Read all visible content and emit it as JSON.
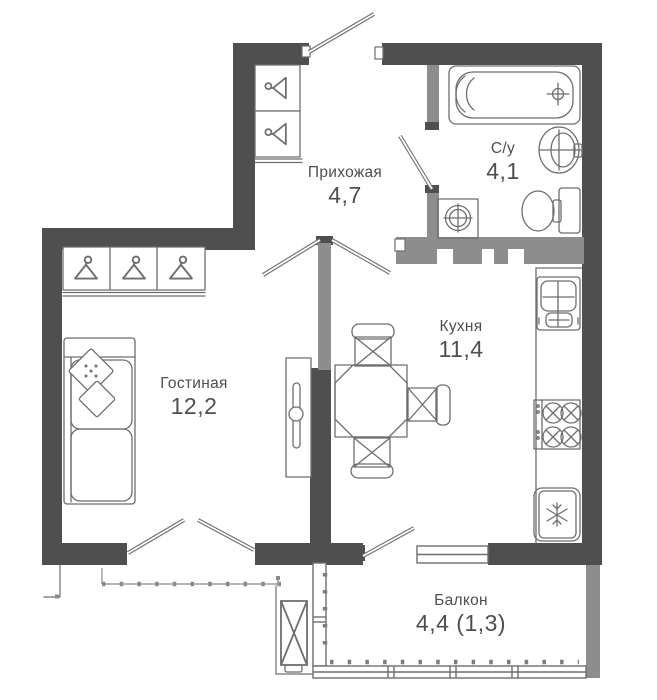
{
  "plan": {
    "type": "apartment-floor-plan",
    "rooms": [
      {
        "id": "hallway",
        "name": "Прихожая",
        "area": "4,7"
      },
      {
        "id": "bathroom",
        "name": "С/у",
        "area": "4,1"
      },
      {
        "id": "kitchen",
        "name": "Кухня",
        "area": "11,4"
      },
      {
        "id": "living",
        "name": "Гостиная",
        "area": "12,2"
      },
      {
        "id": "balcony",
        "name": "Балкон",
        "area": "4,4 (1,3)"
      }
    ],
    "colors": {
      "wall_dark": "#4f4f4f",
      "wall_mid": "#8d8d8d",
      "outline": "#6e6e6e",
      "text": "#4e4e4e",
      "background": "#ffffff"
    },
    "fixtures": [
      "bathtub-icon",
      "washbasin-icon",
      "toilet-icon",
      "washing-machine-icon",
      "kitchen-sink-icon",
      "stove-icon",
      "fridge-icon",
      "dining-table-icon",
      "chair-icon",
      "sofa-icon",
      "tv-stand-icon",
      "hanger-icon",
      "air-conditioner-icon",
      "door-leaf-icon",
      "window-icon",
      "balcony-glazing-icon"
    ]
  }
}
